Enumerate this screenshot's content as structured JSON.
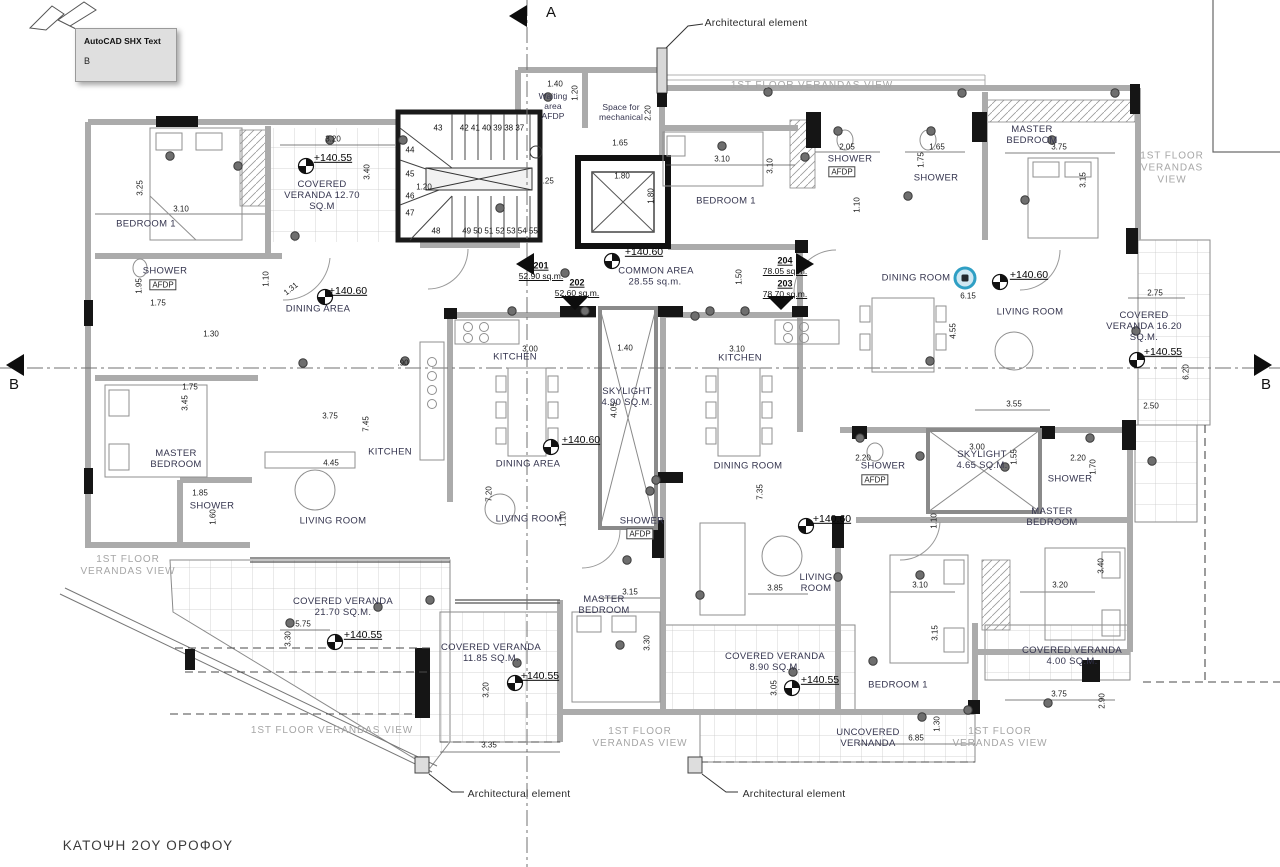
{
  "tooltip": {
    "title": "AutoCAD SHX Text",
    "line": "B"
  },
  "colors": {
    "label_text": "#34344e",
    "dimension_text": "#1c1c1c",
    "muted_text": "#a6a6a6",
    "wall_gray": "#ababab",
    "wall_black": "#151515",
    "highlight_teal": "#2f9fc4",
    "paper": "#ffffff"
  },
  "plan": {
    "title": {
      "t": "ΚΑΤΟΨΗ 2ΟΥ ΟΡΟΦΟΥ",
      "x": 148,
      "y": 846
    },
    "sections": [
      {
        "t": "A",
        "x": 551,
        "y": 13
      },
      {
        "t": "B",
        "x": 14,
        "y": 385
      },
      {
        "t": "B",
        "x": 1266,
        "y": 385
      }
    ],
    "callouts": [
      {
        "t": "Architectural element",
        "x": 756,
        "y": 23
      },
      {
        "t": "Architectural element",
        "x": 519,
        "y": 794
      },
      {
        "t": "Architectural element",
        "x": 794,
        "y": 794
      }
    ],
    "rooms": [
      {
        "n": "bedroom1-201",
        "t": "BEDROOM 1",
        "x": 146,
        "y": 224
      },
      {
        "n": "shower-201",
        "t": "SHOWER",
        "x": 165,
        "y": 271
      },
      {
        "n": "shower-201-afdp",
        "t": "AFDP",
        "x": 163,
        "y": 285,
        "c": "afdp"
      },
      {
        "n": "dining-area-201",
        "t": "DINING AREA",
        "x": 318,
        "y": 309
      },
      {
        "n": "master-bedroom-201",
        "t": "MASTER\nBEDROOM",
        "x": 176,
        "y": 459
      },
      {
        "n": "kitchen-201",
        "t": "KITCHEN",
        "x": 390,
        "y": 452
      },
      {
        "n": "living-room-201",
        "t": "LIVING ROOM",
        "x": 333,
        "y": 521
      },
      {
        "n": "shower2-201",
        "t": "SHOWER",
        "x": 212,
        "y": 506
      },
      {
        "n": "kitchen-202",
        "t": "KITCHEN",
        "x": 515,
        "y": 357
      },
      {
        "n": "dining-area-202",
        "t": "DINING AREA",
        "x": 528,
        "y": 464
      },
      {
        "n": "living-room-202",
        "t": "LIVING ROOM",
        "x": 529,
        "y": 519
      },
      {
        "n": "shower-202",
        "t": "SHOWER",
        "x": 642,
        "y": 521
      },
      {
        "n": "shower-202-afdp",
        "t": "AFDP",
        "x": 640,
        "y": 534,
        "c": "afdp"
      },
      {
        "n": "master-bedroom-202",
        "t": "MASTER\nBEDROOM",
        "x": 604,
        "y": 605
      },
      {
        "n": "skylight-490",
        "t": "SKYLIGHT\n4.90 SQ.M.",
        "x": 627,
        "y": 397
      },
      {
        "n": "kitchen-203",
        "t": "KITCHEN",
        "x": 740,
        "y": 358
      },
      {
        "n": "dining-room-203",
        "t": "DINING ROOM",
        "x": 748,
        "y": 466
      },
      {
        "n": "living-room-203",
        "t": "LIVING\nROOM",
        "x": 816,
        "y": 583
      },
      {
        "n": "shower-203",
        "t": "SHOWER",
        "x": 883,
        "y": 466
      },
      {
        "n": "shower-203-afdp",
        "t": "AFDP",
        "x": 875,
        "y": 480,
        "c": "afdp"
      },
      {
        "n": "skylight-465",
        "t": "SKYLIGHT\n4.65 SQ.M.",
        "x": 982,
        "y": 460
      },
      {
        "n": "shower2-203",
        "t": "SHOWER",
        "x": 1070,
        "y": 479
      },
      {
        "n": "master-bedroom-203",
        "t": "MASTER\nBEDROOM",
        "x": 1052,
        "y": 517
      },
      {
        "n": "bedroom1-203",
        "t": "BEDROOM 1",
        "x": 898,
        "y": 685
      },
      {
        "n": "bedroom1-204",
        "t": "BEDROOM 1",
        "x": 726,
        "y": 201
      },
      {
        "n": "shower-204",
        "t": "SHOWER",
        "x": 850,
        "y": 159
      },
      {
        "n": "shower-204-afdp",
        "t": "AFDP",
        "x": 842,
        "y": 172,
        "c": "afdp"
      },
      {
        "n": "shower2-204",
        "t": "SHOWER",
        "x": 936,
        "y": 178
      },
      {
        "n": "master-bedroom-204",
        "t": "MASTER\nBEDROOM",
        "x": 1032,
        "y": 135
      },
      {
        "n": "dining-room-204",
        "t": "DINING ROOM",
        "x": 916,
        "y": 278
      },
      {
        "n": "living-room-204",
        "t": "LIVING ROOM",
        "x": 1030,
        "y": 312
      },
      {
        "n": "waiting-area",
        "t": "Waiting\narea\nAFDP",
        "x": 553,
        "y": 106,
        "c": "waiting"
      },
      {
        "n": "space-for-mechanical",
        "t": "Space for\nmechanical",
        "x": 621,
        "y": 112,
        "c": "waiting"
      }
    ],
    "verandas": [
      {
        "n": "covered-veranda-1270",
        "t": "COVERED\nVERANDA 12.70\nSQ.M",
        "x": 322,
        "y": 196
      },
      {
        "n": "covered-veranda-1620",
        "t": "COVERED\nVERANDA 16.20\nSQ.M.",
        "x": 1144,
        "y": 327
      },
      {
        "n": "covered-veranda-2170",
        "t": "COVERED VERANDA\n21.70 SQ.M.",
        "x": 343,
        "y": 607
      },
      {
        "n": "covered-veranda-1185",
        "t": "COVERED VERANDA\n11.85 SQ.M.",
        "x": 491,
        "y": 653
      },
      {
        "n": "covered-veranda-890",
        "t": "COVERED VERANDA\n8.90 SQ.M.",
        "x": 775,
        "y": 662
      },
      {
        "n": "covered-veranda-400",
        "t": "COVERED VERANDA\n4.00 SQ.M.",
        "x": 1072,
        "y": 656
      },
      {
        "n": "uncovered-vernanda",
        "t": "UNCOVERED\nVERNANDA",
        "x": 868,
        "y": 738
      }
    ],
    "views": [
      {
        "t": "1ST FLOOR VERANDAS VIEW",
        "x": 812,
        "y": 86
      },
      {
        "t": "1ST FLOOR\nVERANDAS\nVIEW",
        "x": 1172,
        "y": 168
      },
      {
        "t": "1ST FLOOR\nVERANDAS VIEW",
        "x": 128,
        "y": 566
      },
      {
        "t": "1ST FLOOR VERANDAS VIEW",
        "x": 332,
        "y": 731
      },
      {
        "t": "1ST FLOOR\nVERANDAS VIEW",
        "x": 640,
        "y": 738
      },
      {
        "t": "1ST FLOOR\nVERANDAS VIEW",
        "x": 1000,
        "y": 738
      }
    ],
    "apartments": [
      {
        "id": "201",
        "area": "52.90 sq.m.",
        "x": 541,
        "y": 266
      },
      {
        "id": "202",
        "area": "52.60 sq.m.",
        "x": 577,
        "y": 283
      },
      {
        "id": "204",
        "area": "78.05 sq.m.",
        "x": 785,
        "y": 261
      },
      {
        "id": "203",
        "area": "78.70 sq.m.",
        "x": 785,
        "y": 284
      }
    ],
    "common": {
      "label": "COMMON AREA",
      "area": "28.55 sq.m.",
      "x": 656,
      "y": 271
    },
    "elevations": [
      {
        "t": "+140.55",
        "x": 333,
        "y": 158,
        "mx": 306,
        "my": 166
      },
      {
        "t": "+140.60",
        "x": 348,
        "y": 291,
        "mx": 325,
        "my": 297
      },
      {
        "t": "+140.60",
        "x": 644,
        "y": 252,
        "mx": 612,
        "my": 261
      },
      {
        "t": "+140.60",
        "x": 1029,
        "y": 275,
        "mx": 1000,
        "my": 282
      },
      {
        "t": "+140.55",
        "x": 1163,
        "y": 352,
        "mx": 1137,
        "my": 360
      },
      {
        "t": "+140.60",
        "x": 581,
        "y": 440,
        "mx": 551,
        "my": 447
      },
      {
        "t": "+140.60",
        "x": 832,
        "y": 519,
        "mx": 806,
        "my": 526
      },
      {
        "t": "+140.55",
        "x": 363,
        "y": 635,
        "mx": 335,
        "my": 642
      },
      {
        "t": "+140.55",
        "x": 540,
        "y": 676,
        "mx": 515,
        "my": 683
      },
      {
        "t": "+140.55",
        "x": 820,
        "y": 680,
        "mx": 792,
        "my": 688
      }
    ],
    "dimensions": [
      {
        "t": "3.20",
        "x": 333,
        "y": 139
      },
      {
        "t": "3.25",
        "x": 140,
        "y": 188,
        "r": -90
      },
      {
        "t": "3.10",
        "x": 181,
        "y": 209
      },
      {
        "t": "3.40",
        "x": 367,
        "y": 172,
        "r": -90
      },
      {
        "t": "1.95",
        "x": 139,
        "y": 286,
        "r": -90
      },
      {
        "t": "1.75",
        "x": 158,
        "y": 303
      },
      {
        "t": "1.10",
        "x": 266,
        "y": 279,
        "r": -90
      },
      {
        "t": "1.31",
        "x": 291,
        "y": 289,
        "r": -38
      },
      {
        "t": "1.40",
        "x": 555,
        "y": 84
      },
      {
        "t": "1.20",
        "x": 575,
        "y": 93,
        "r": -90
      },
      {
        "t": "2.20",
        "x": 648,
        "y": 113,
        "r": -90
      },
      {
        "t": "1.65",
        "x": 620,
        "y": 143
      },
      {
        "t": "1.25",
        "x": 546,
        "y": 181
      },
      {
        "t": "1.20",
        "x": 424,
        "y": 187
      },
      {
        "t": "1.80",
        "x": 622,
        "y": 176
      },
      {
        "t": "1.80",
        "x": 651,
        "y": 196,
        "r": -90
      },
      {
        "t": "3.10",
        "x": 722,
        "y": 159
      },
      {
        "t": "3.10",
        "x": 770,
        "y": 166,
        "r": -90
      },
      {
        "t": "2.05",
        "x": 847,
        "y": 147
      },
      {
        "t": "1.65",
        "x": 937,
        "y": 147
      },
      {
        "t": "1.75",
        "x": 921,
        "y": 160,
        "r": -90
      },
      {
        "t": "1.10",
        "x": 857,
        "y": 205,
        "r": -90
      },
      {
        "t": "3.75",
        "x": 1059,
        "y": 147
      },
      {
        "t": "3.15",
        "x": 1083,
        "y": 180,
        "r": -90
      },
      {
        "t": "1.50",
        "x": 739,
        "y": 277,
        "r": -90
      },
      {
        "t": "6.15",
        "x": 968,
        "y": 296
      },
      {
        "t": "4.55",
        "x": 953,
        "y": 331,
        "r": -90
      },
      {
        "t": "2.75",
        "x": 1155,
        "y": 293
      },
      {
        "t": "6.20",
        "x": 1186,
        "y": 372,
        "r": -90
      },
      {
        "t": "2.50",
        "x": 1151,
        "y": 406
      },
      {
        "t": "3.55",
        "x": 1014,
        "y": 404
      },
      {
        "t": "1.75",
        "x": 190,
        "y": 387
      },
      {
        "t": "3.45",
        "x": 185,
        "y": 403,
        "r": -90
      },
      {
        "t": "1.30",
        "x": 211,
        "y": 334
      },
      {
        "t": "3.75",
        "x": 330,
        "y": 416
      },
      {
        "t": "7.45",
        "x": 366,
        "y": 424,
        "r": -90
      },
      {
        "t": ".90",
        "x": 403,
        "y": 363
      },
      {
        "t": "4.45",
        "x": 331,
        "y": 463
      },
      {
        "t": "1.85",
        "x": 200,
        "y": 493
      },
      {
        "t": "1.60",
        "x": 213,
        "y": 517,
        "r": -90
      },
      {
        "t": "3.00",
        "x": 530,
        "y": 349
      },
      {
        "t": "1.40",
        "x": 625,
        "y": 348
      },
      {
        "t": "3.10",
        "x": 737,
        "y": 349
      },
      {
        "t": "4.05",
        "x": 614,
        "y": 410,
        "r": -90
      },
      {
        "t": "7.20",
        "x": 489,
        "y": 494,
        "r": -90
      },
      {
        "t": "7.35",
        "x": 760,
        "y": 492,
        "r": -90
      },
      {
        "t": "1.10",
        "x": 563,
        "y": 519,
        "r": -90
      },
      {
        "t": "1.10",
        "x": 934,
        "y": 521,
        "r": -90
      },
      {
        "t": "2.20",
        "x": 863,
        "y": 458
      },
      {
        "t": "2.20",
        "x": 1078,
        "y": 458
      },
      {
        "t": "3.00",
        "x": 977,
        "y": 447
      },
      {
        "t": "1.55",
        "x": 1014,
        "y": 457,
        "r": -90
      },
      {
        "t": "1.70",
        "x": 1093,
        "y": 467,
        "r": -90
      },
      {
        "t": "3.15",
        "x": 630,
        "y": 592
      },
      {
        "t": "3.30",
        "x": 647,
        "y": 643,
        "r": -90
      },
      {
        "t": "3.85",
        "x": 775,
        "y": 588
      },
      {
        "t": "3.10",
        "x": 920,
        "y": 585
      },
      {
        "t": "3.20",
        "x": 1060,
        "y": 585
      },
      {
        "t": "3.40",
        "x": 1101,
        "y": 566,
        "r": -90
      },
      {
        "t": "5.75",
        "x": 303,
        "y": 624
      },
      {
        "t": "3.30",
        "x": 288,
        "y": 639,
        "r": -90
      },
      {
        "t": "3.20",
        "x": 486,
        "y": 690,
        "r": -90
      },
      {
        "t": "3.35",
        "x": 489,
        "y": 745
      },
      {
        "t": "3.05",
        "x": 774,
        "y": 688,
        "r": -90
      },
      {
        "t": "3.15",
        "x": 935,
        "y": 633,
        "r": -90
      },
      {
        "t": "1.30",
        "x": 937,
        "y": 724,
        "r": -90
      },
      {
        "t": "6.85",
        "x": 916,
        "y": 738
      },
      {
        "t": "3.75",
        "x": 1059,
        "y": 694
      },
      {
        "t": "2.90",
        "x": 1102,
        "y": 701,
        "r": -90
      }
    ],
    "stair_numbers": [
      {
        "t": "43",
        "x": 438,
        "y": 128
      },
      {
        "t": "42 41 40 39 38 37",
        "x": 492,
        "y": 128
      },
      {
        "t": "44",
        "x": 410,
        "y": 150
      },
      {
        "t": "45",
        "x": 410,
        "y": 174
      },
      {
        "t": "46",
        "x": 410,
        "y": 196
      },
      {
        "t": "47",
        "x": 410,
        "y": 213
      },
      {
        "t": "48",
        "x": 436,
        "y": 231
      },
      {
        "t": "49 50 51 52 53 54 55",
        "x": 500,
        "y": 231
      }
    ],
    "grips": [
      [
        170,
        156
      ],
      [
        238,
        166
      ],
      [
        295,
        236
      ],
      [
        330,
        140
      ],
      [
        403,
        140
      ],
      [
        548,
        97
      ],
      [
        500,
        208
      ],
      [
        565,
        273
      ],
      [
        722,
        146
      ],
      [
        805,
        157
      ],
      [
        838,
        131
      ],
      [
        931,
        131
      ],
      [
        1052,
        140
      ],
      [
        1025,
        200
      ],
      [
        908,
        196
      ],
      [
        1005,
        467
      ],
      [
        920,
        456
      ],
      [
        1136,
        331
      ],
      [
        1152,
        461
      ],
      [
        303,
        363
      ],
      [
        405,
        361
      ],
      [
        512,
        311
      ],
      [
        585,
        311
      ],
      [
        710,
        311
      ],
      [
        745,
        311
      ],
      [
        930,
        361
      ],
      [
        627,
        560
      ],
      [
        650,
        491
      ],
      [
        656,
        480
      ],
      [
        838,
        577
      ],
      [
        920,
        575
      ],
      [
        700,
        595
      ],
      [
        517,
        663
      ],
      [
        620,
        645
      ],
      [
        793,
        672
      ],
      [
        873,
        661
      ],
      [
        922,
        717
      ],
      [
        968,
        710
      ],
      [
        1048,
        703
      ],
      [
        378,
        607
      ],
      [
        290,
        623
      ],
      [
        430,
        600
      ],
      [
        695,
        316
      ],
      [
        768,
        92
      ],
      [
        860,
        438
      ],
      [
        1090,
        438
      ],
      [
        962,
        93
      ],
      [
        1115,
        93
      ]
    ],
    "arrows": [
      {
        "d": "left",
        "x": 526,
        "y": 264
      },
      {
        "d": "down",
        "x": 575,
        "y": 302
      },
      {
        "d": "right",
        "x": 804,
        "y": 264
      },
      {
        "d": "down",
        "x": 781,
        "y": 302
      },
      {
        "d": "left",
        "x": 519,
        "y": 16
      },
      {
        "d": "left",
        "x": 16,
        "y": 365
      },
      {
        "d": "right",
        "x": 1262,
        "y": 365
      }
    ],
    "highlight": {
      "x": 965,
      "y": 278
    }
  }
}
